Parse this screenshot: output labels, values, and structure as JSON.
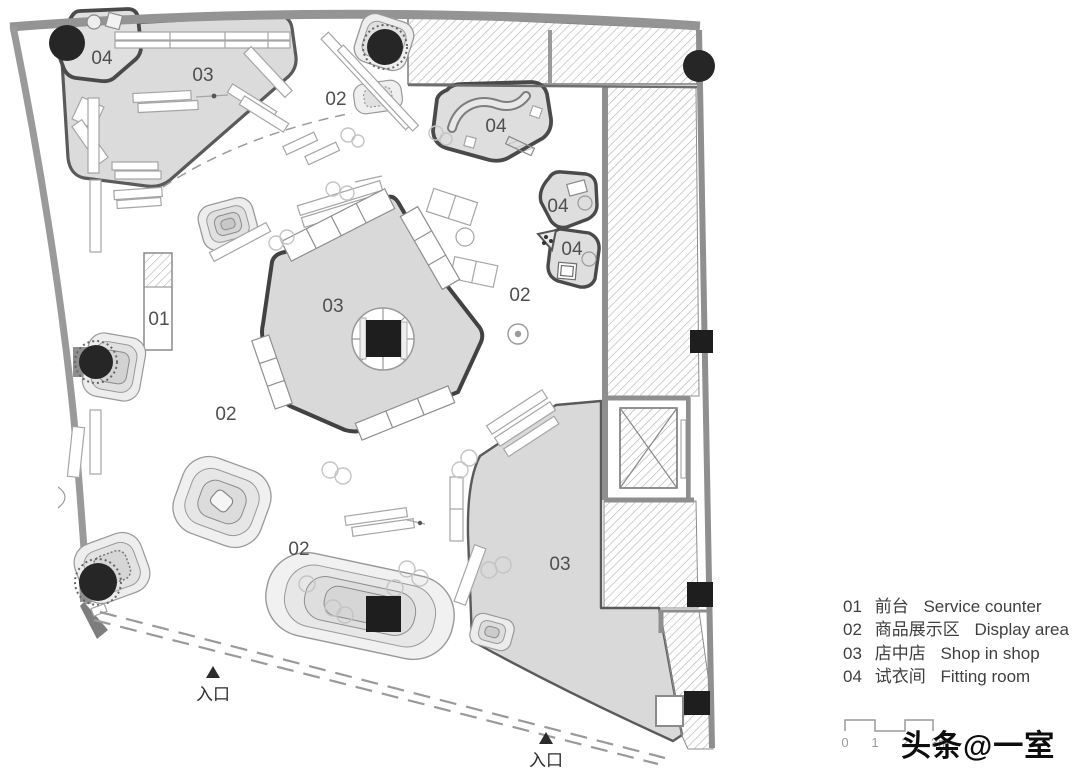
{
  "legend": {
    "items": [
      {
        "code": "01",
        "zh": "前台",
        "en": "Service counter"
      },
      {
        "code": "02",
        "zh": "商品展示区",
        "en": "Display area"
      },
      {
        "code": "03",
        "zh": "店中店",
        "en": "Shop in shop"
      },
      {
        "code": "04",
        "zh": "试衣间",
        "en": "Fitting room"
      }
    ]
  },
  "plan": {
    "area_labels": {
      "shop_top_left": "03",
      "fitting_top_left": "04",
      "display_top": "02",
      "fitting_top_mid": "04",
      "fitting_right_upper": "04",
      "fitting_right_lower": "04",
      "display_mid_right": "02",
      "shop_center": "03",
      "service_counter": "01",
      "display_mid_left": "02",
      "display_bottom": "02",
      "shop_bottom_right": "03"
    },
    "entrances": [
      {
        "label": "入口"
      },
      {
        "label": "入口"
      }
    ]
  },
  "scalebar": {
    "ticks": [
      "0",
      "1",
      "2",
      "3m"
    ]
  },
  "watermark": {
    "text": "头条@一室"
  },
  "colors": {
    "room_fill": "#dadada",
    "room_fill_light": "#e2e2e2",
    "wall_grey": "#8f8f8f",
    "outline_dark": "#4f4f4f",
    "hatch_line": "#b5b5b5",
    "marker_black": "#222222",
    "label_grey": "#4f4f4f"
  }
}
